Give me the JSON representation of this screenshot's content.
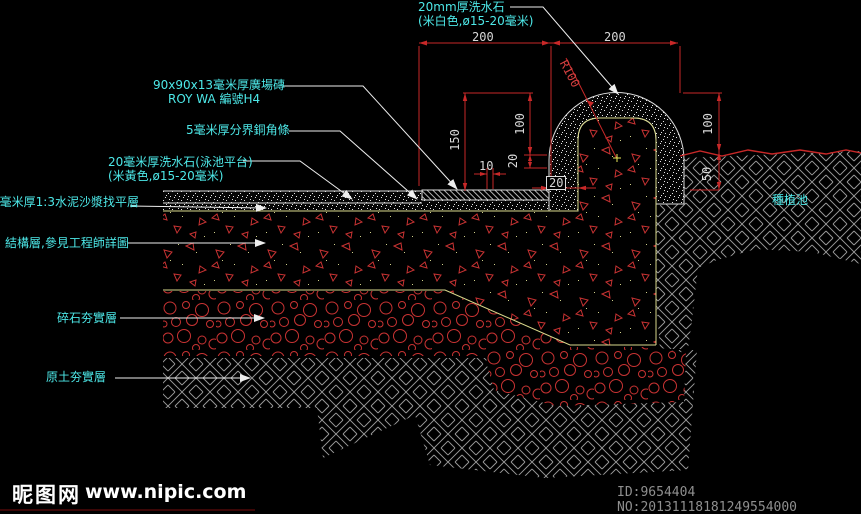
{
  "drawing": {
    "labels": {
      "top_material_line1": "20mm厚洗水石",
      "top_material_line2": "(米白色,ø15-20毫米)",
      "tile_line1": "90x90x13毫米厚廣場磚",
      "tile_line2": "ROY WA 編號H4",
      "copper_strip": "5毫米厚分界銅角條",
      "washstone_deck_line1": "20毫米厚洗水石(泳池平台)",
      "washstone_deck_line2": "(米黃色,ø15-20毫米)",
      "leveling_layer": "0毫米厚1:3水泥沙漿找平層",
      "structure_layer": "結構層,參見工程師詳圖",
      "gravel_layer": "碎石夯實層",
      "soil_layer": "原土夯實層",
      "planting_area": "種植池"
    },
    "dims": {
      "span_left": "200",
      "span_right": "200",
      "height_left": "150",
      "height_arch_left": "100",
      "offset_vertical": "20",
      "joint_width": "10",
      "coping_thickness": "20",
      "radius": "R100",
      "height_arch_right": "100",
      "soil_depth_right": "50"
    },
    "colors": {
      "dimension_red": "#c82828",
      "label_cyan": "#4de8e8",
      "outline_khaki": "#d9d98c",
      "hatch_gray": "#9a9a9a",
      "line_white": "#e8e8e8"
    }
  },
  "watermark": {
    "site_name": "昵图网",
    "site_url": "www.nipic.com",
    "id_text": "ID:9654404 NO:20131118181249554000"
  }
}
